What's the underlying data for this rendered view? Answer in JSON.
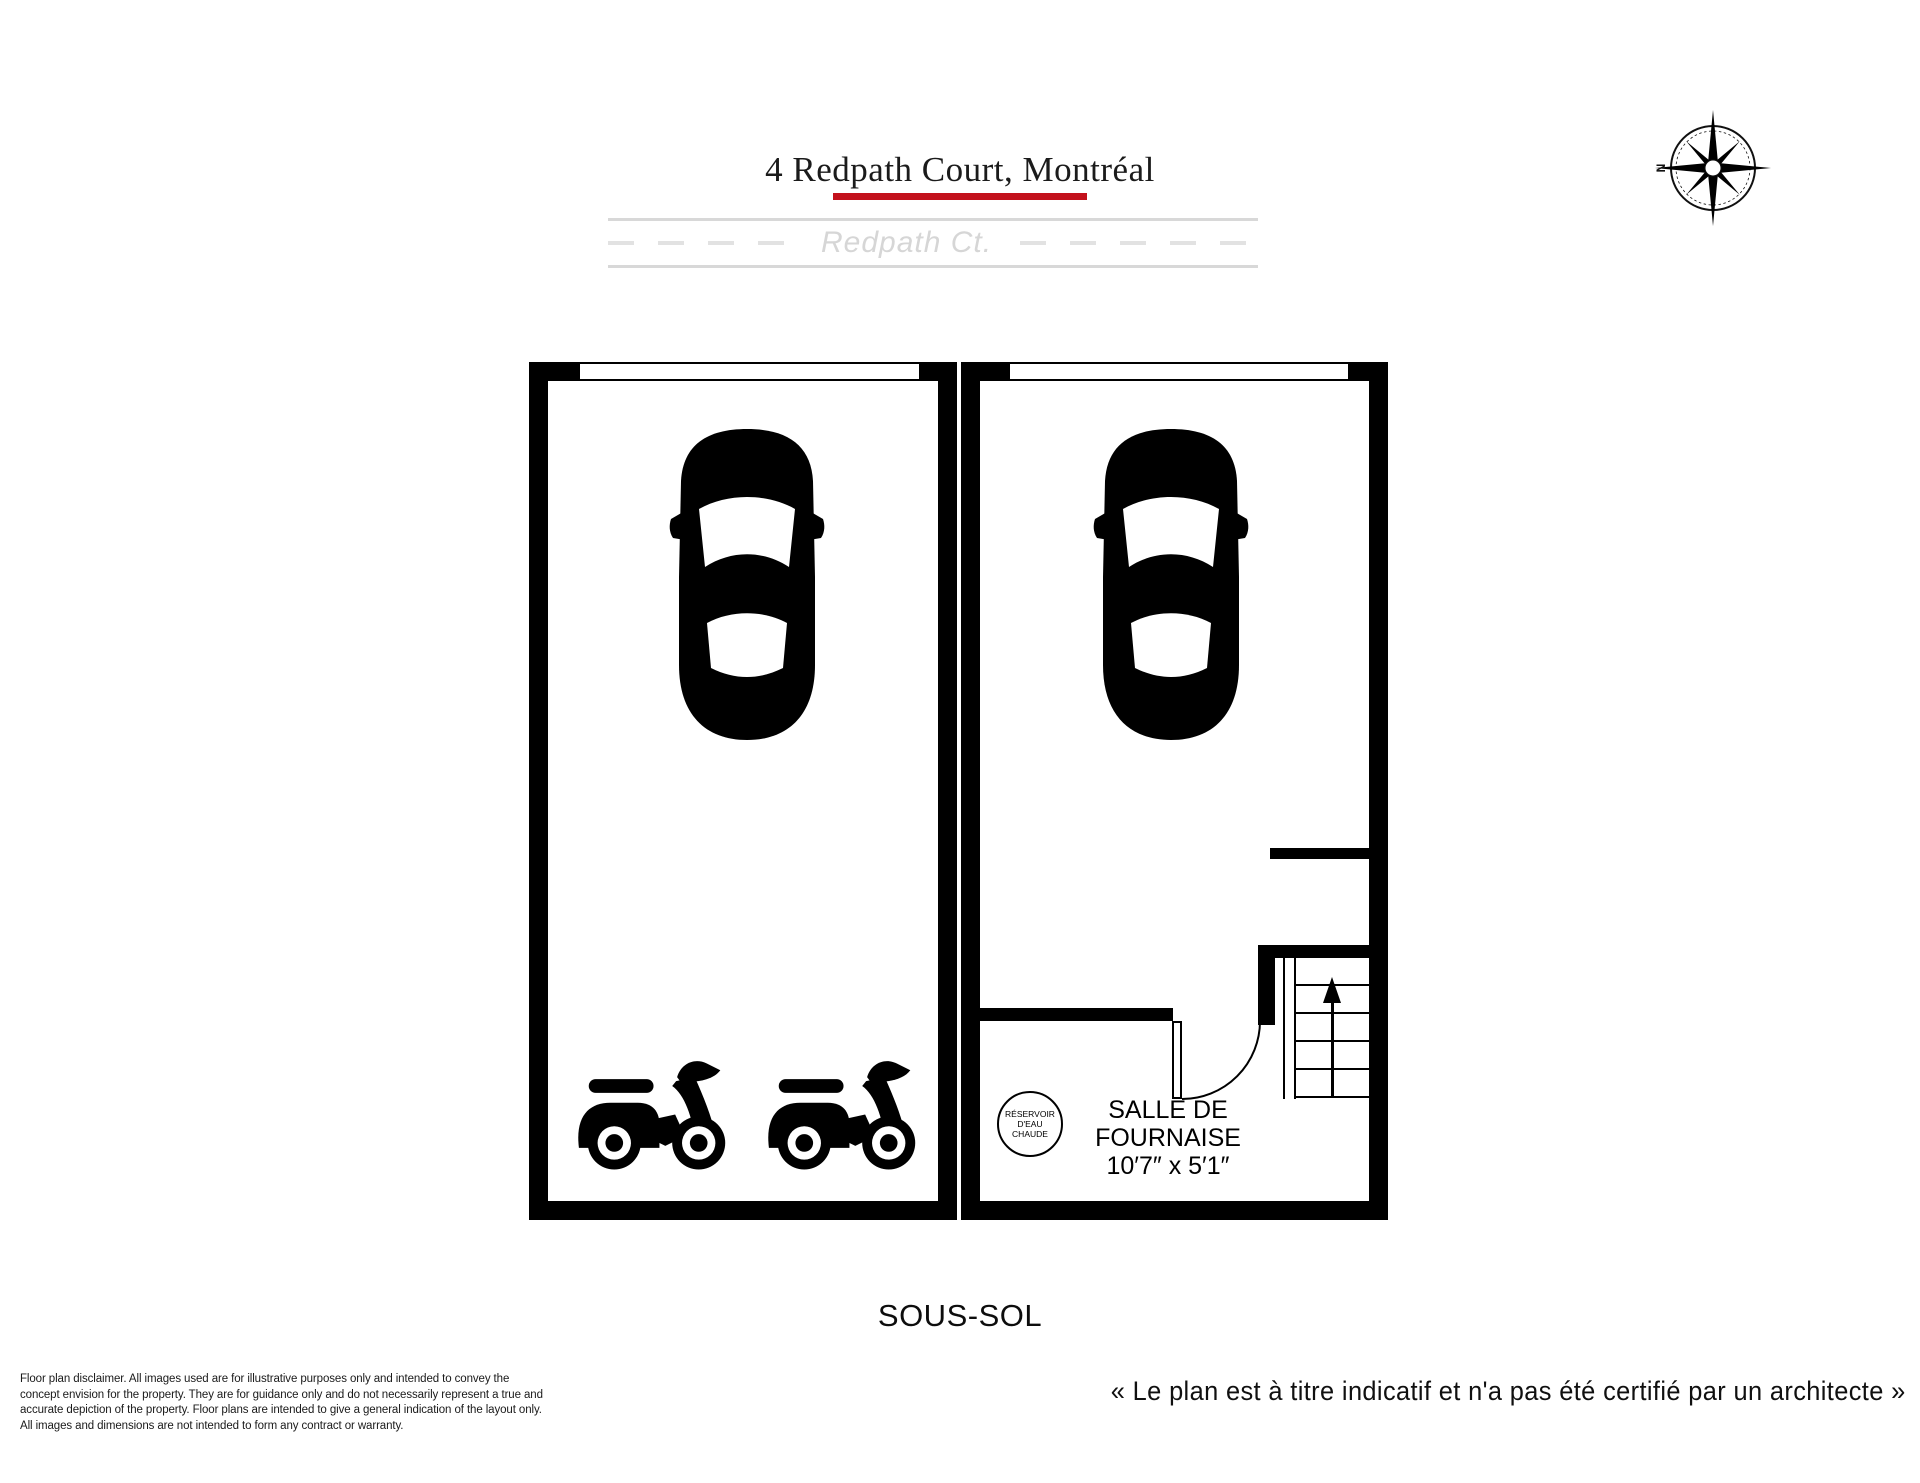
{
  "header": {
    "title": "4 Redpath Court, Montréal",
    "accent_color": "#c3111c"
  },
  "street": {
    "label": "Redpath Ct.",
    "line_color": "#d8d8d8"
  },
  "compass": {
    "north_label": "N"
  },
  "plan": {
    "floor_label": "SOUS-SOL",
    "wall_color": "#000000",
    "furnace_room": {
      "name": "SALLE DE\nFOURNAISE",
      "dimensions": "10′7″ x 5′1″"
    },
    "water_heater": {
      "label": "RÉSERVOIR D'EAU\nCHAUDE"
    }
  },
  "footer": {
    "disclaimer": "Floor plan disclaimer. All images used are for illustrative purposes only and intended to convey the\nconcept envision for the property. They are for guidance only and do not necessarily represent a true and\naccurate depiction of the property. Floor plans are intended to give a general indication of the layout only.\nAll images and dimensions are not intended to form any contract or warranty.",
    "certification_note": "« Le plan est à titre indicatif et n'a pas été certifié par un architecte »"
  }
}
